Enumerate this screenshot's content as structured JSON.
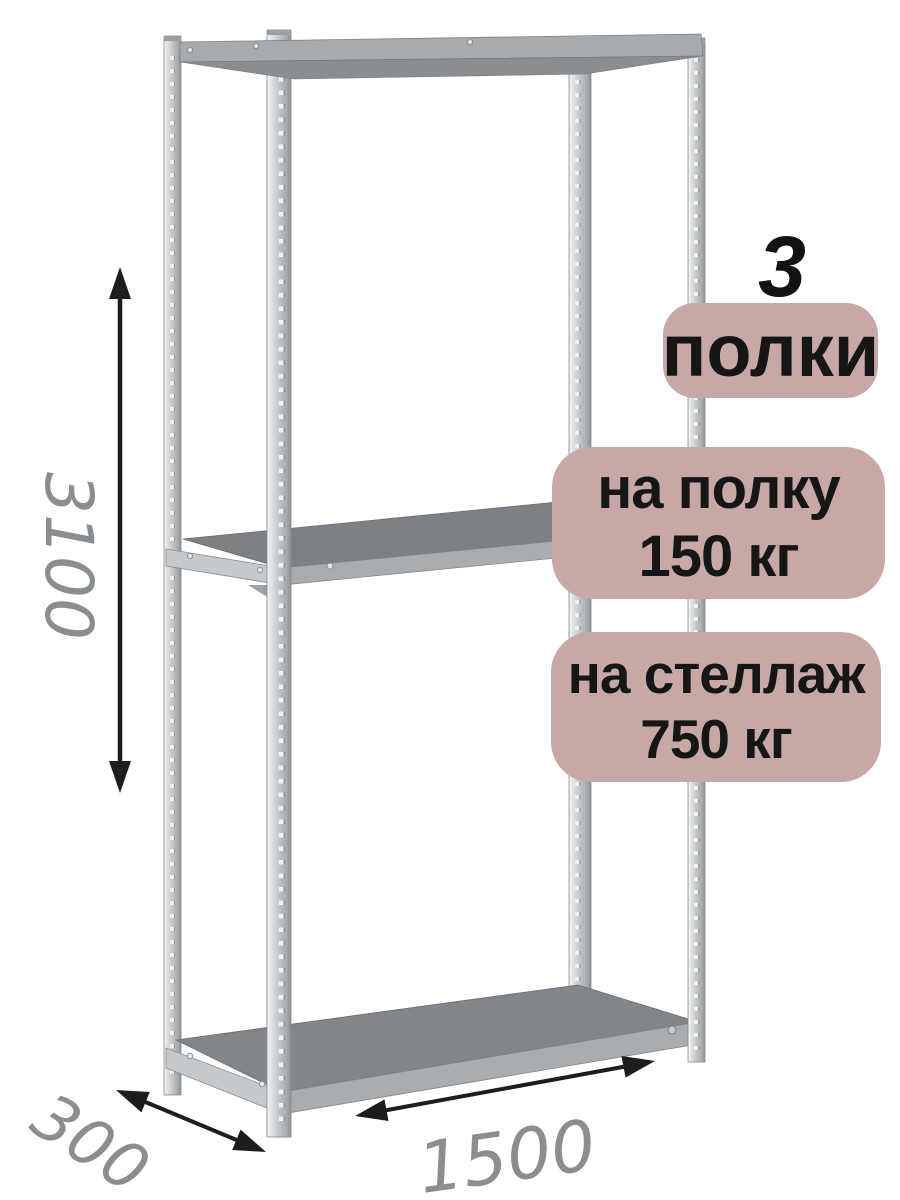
{
  "product": {
    "shelf_count": "3",
    "shelf_count_label": "полки",
    "per_shelf_line1": "на полку",
    "per_shelf_line2": "150 кг",
    "per_rack_line1": "на стеллаж",
    "per_rack_line2": "750 кг"
  },
  "dimensions": {
    "height_mm": "3100",
    "depth_mm": "300",
    "width_mm": "1500"
  },
  "illustration": {
    "subject": "3-shelf boltless metal shelving rack, three-quarter view",
    "shelf_positions": [
      "top",
      "middle",
      "bottom"
    ]
  },
  "colors": {
    "background": "#ffffff",
    "badge_bg": "#c8a8a6",
    "badge_text": "#161616",
    "dimension_text": "#8b8e90",
    "arrow": "#1d1d1d",
    "metal_light": "#eceeef",
    "metal_mid": "#c3c6c8",
    "metal_dark": "#94979a",
    "shelf_top": "#7d8084",
    "shelf_front": "#aaadb0"
  }
}
